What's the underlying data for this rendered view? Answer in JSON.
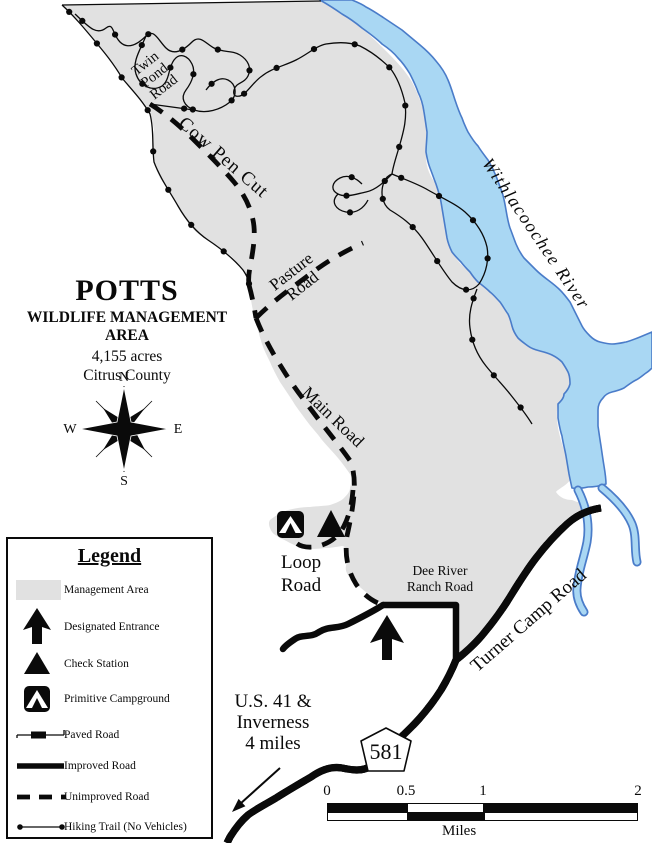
{
  "map": {
    "title": {
      "name": "POTTS",
      "subtitle": "WILDLIFE MANAGEMENT AREA",
      "acreage": "4,155 acres",
      "county": "Citrus County"
    },
    "compass": {
      "n": "N",
      "s": "S",
      "e": "E",
      "w": "W"
    },
    "labels": {
      "twin_pond_road": {
        "line1": "Twin",
        "line2": "Pond",
        "line3": "Road"
      },
      "cow_pen_cut": "Cow Pen Cut",
      "pasture_road": {
        "line1": "Pasture",
        "line2": "Road"
      },
      "main_road": "Main Road",
      "loop_road": {
        "line1": "Loop",
        "line2": "Road"
      },
      "dee_river_ranch_road": {
        "line1": "Dee River",
        "line2": "Ranch Road"
      },
      "turner_camp_road": "Turner Camp Road",
      "withlacoochee_river": "Withlacoochee River",
      "highway_shield": "581",
      "direction_note": {
        "line1": "U.S. 41 &",
        "line2": "Inverness",
        "line3": "4 miles"
      }
    },
    "scale_bar": {
      "ticks": [
        "0",
        "0.5",
        "1",
        "2"
      ],
      "unit": "Miles"
    }
  },
  "legend": {
    "title": "Legend",
    "items": [
      {
        "icon": "management-area-swatch",
        "label": "Management Area"
      },
      {
        "icon": "designated-entrance-arrow",
        "label": "Designated Entrance"
      },
      {
        "icon": "check-station-triangle",
        "label": "Check Station"
      },
      {
        "icon": "primitive-campground-symbol",
        "label": "Primitive Campground"
      },
      {
        "icon": "paved-road-line",
        "label": "Paved Road"
      },
      {
        "icon": "improved-road-line",
        "label": "Improved Road"
      },
      {
        "icon": "unimproved-road-line",
        "label": "Unimproved Road"
      },
      {
        "icon": "hiking-trail-line",
        "label": "Hiking Trail (No Vehicles)"
      }
    ]
  },
  "colors": {
    "management_area": "#e1e1e1",
    "river_fill": "#a9d7f3",
    "river_stroke": "#4a7cc9",
    "ink": "#0a0a0a"
  }
}
